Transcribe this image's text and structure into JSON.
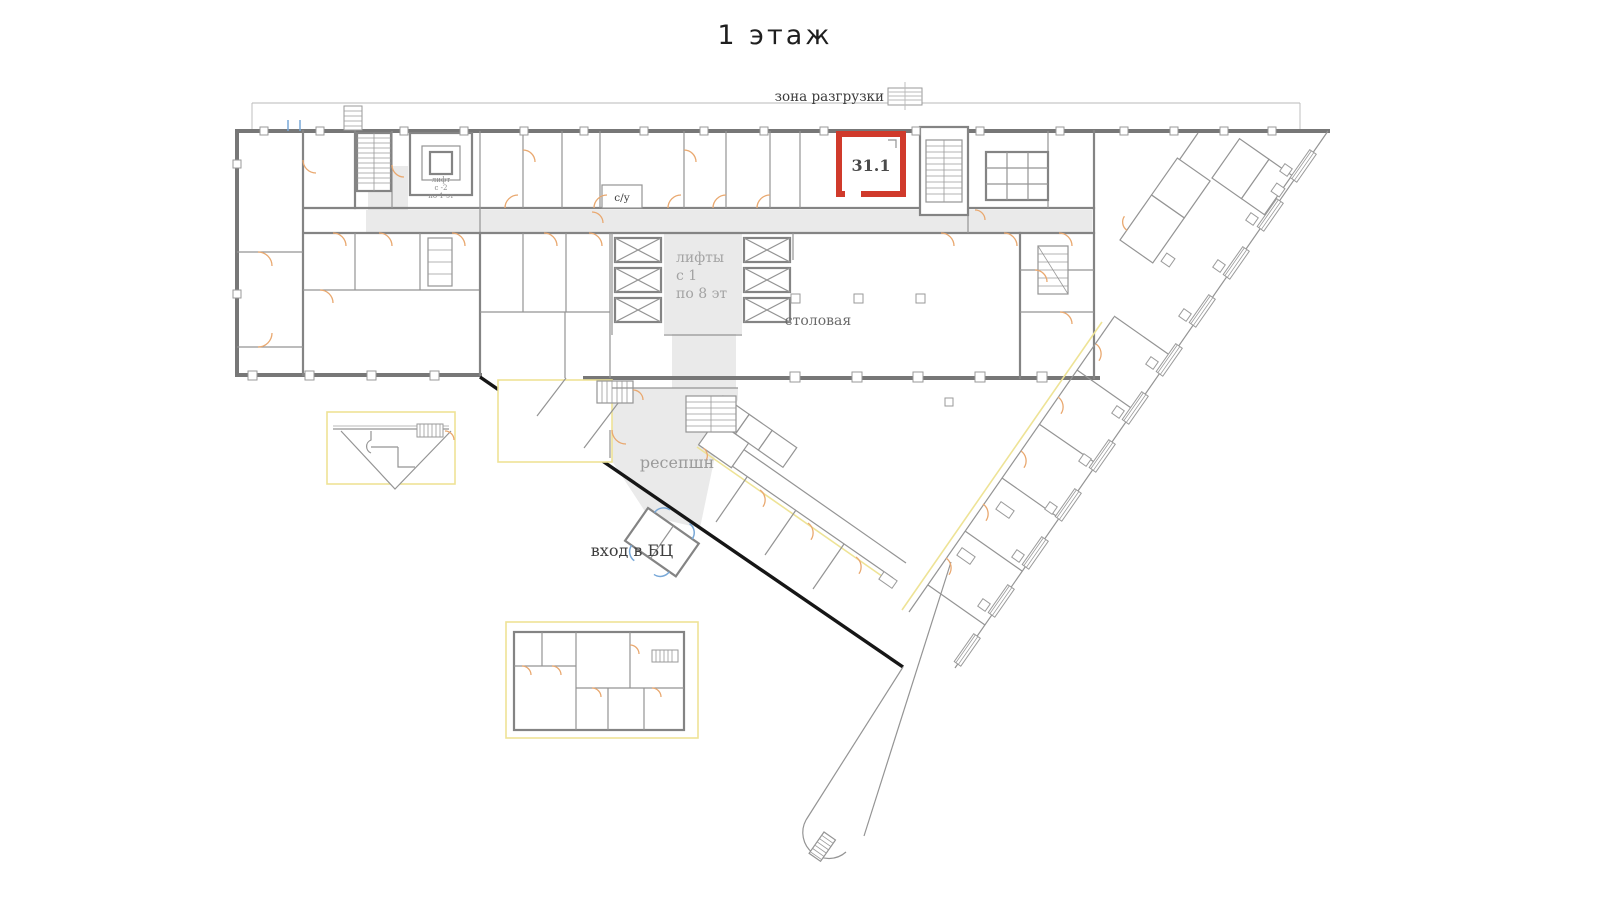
{
  "title": "1 этаж",
  "plan": {
    "unloading_zone_label": "зона разгрузки",
    "highlight_room": {
      "id": "31.1"
    },
    "wc_label": "с/у",
    "service_lift": [
      "лифт",
      "с -2",
      "по 1 эт"
    ],
    "passenger_lifts": [
      "лифты",
      "с 1",
      "по 8 эт"
    ],
    "canteen_label": "столовая",
    "reception_label": "ресепшн",
    "entrance_label": "вход в БЦ"
  },
  "colors": {
    "highlight": "#d03a2b",
    "door_arc": "#e9a86f",
    "entrance_door": "#78a8d8",
    "corridor_fill": "#eaeaea",
    "accent_outline": "#eee396",
    "wall": "#7a7a7a",
    "facade_black": "#161616"
  }
}
